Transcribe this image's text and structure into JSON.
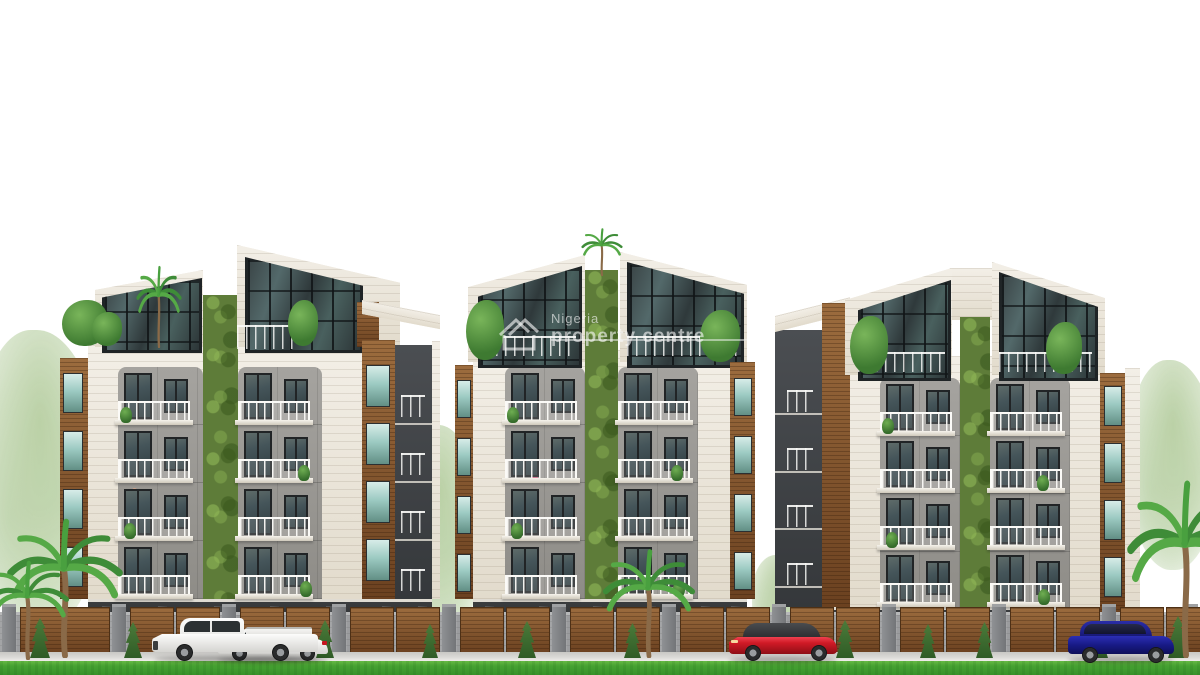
{
  "watermark": {
    "icon": "house-outline-icon",
    "line1": "Nigeria",
    "line2": "property centre",
    "color": "rgba(248,248,248,0.62)"
  },
  "scene": {
    "type": "architectural-rendering",
    "subject": "Three modern apartment blocks with slanted glass penthouses, vertical garden strips, balconies, perimeter fence, parked cars, palm trees and lawn",
    "palette": {
      "sky": "#ffffff",
      "facade_white": "#ece7dc",
      "wood_accent": "#7d4f2a",
      "panel_grey": "#9a9894",
      "charcoal": "#3c3f42",
      "green_wall": "#5e7c39",
      "glass_dark": "#36484a",
      "glass_light": "#bfe0dc",
      "fence_grey": "#9b9c9e",
      "grass_green": "#42a034",
      "car_white": "#f4f4f2",
      "car_red": "#d01a26",
      "car_blue": "#1d2090"
    },
    "counts": {
      "buildings": 3,
      "cars": 4,
      "palm_trees": 4
    }
  }
}
